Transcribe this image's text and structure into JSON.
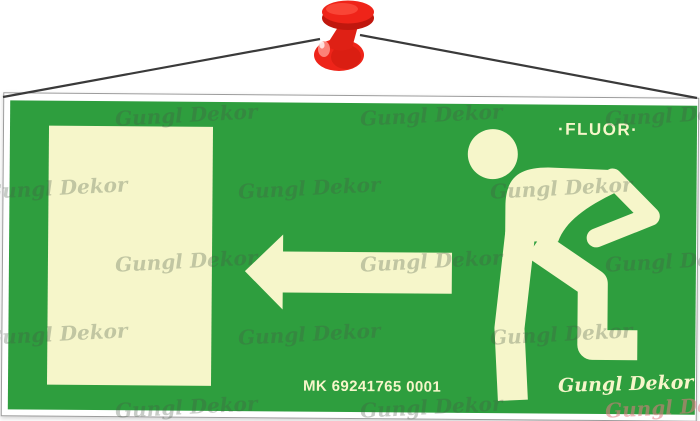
{
  "sign": {
    "fluor_label": "·FLUOR·",
    "product_code": "MK 69241765 0001",
    "brand_signature": "Gungl Dekor",
    "watermark_text": "Gungl Dekor",
    "pictograms": {
      "door": "exit-door-panel",
      "arrow": "arrow-pointing-left",
      "figure": "running-man-toward-exit"
    },
    "colors": {
      "sign_green": "#2e9e3e",
      "glow_cream": "#f6f6ca",
      "pin_red": "#ee2419",
      "pin_red_dark": "#c0170e",
      "string_gray": "#3a3a3a"
    }
  }
}
